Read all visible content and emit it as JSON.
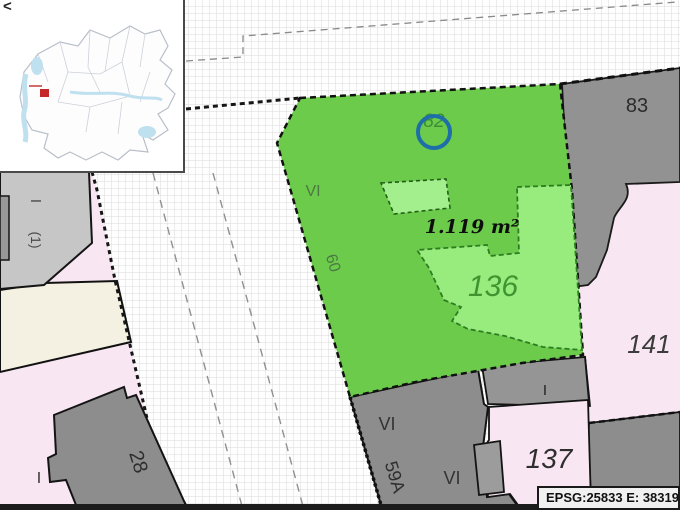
{
  "status_bar": {
    "text": "EPSG:25833 E: 38319"
  },
  "overview_map": {
    "collapse_icon": "<"
  },
  "labels": {
    "marker_82": "82",
    "floors_vi_green": "VI",
    "house_60": "60",
    "area_1119": "1.119 m²",
    "parcel_136": "136",
    "house_83": "83",
    "parcel_141": "141",
    "parcel_137": "137",
    "floors_i_finger": "I",
    "floors_vi_upper": "VI",
    "house_59a": "59A",
    "floors_vi_lower": "VI",
    "house_28": "28",
    "floors_i_west": "I",
    "floors_i_building": "I",
    "units_1": "(1)"
  },
  "colors": {
    "selected_parcel_green": "#6ccb4b",
    "subparcel_light_green": "#97ec7d",
    "inner_building_green": "#a4ef8d",
    "building_gray": "#8d8d8d",
    "building_light_gray": "#c6c6c6",
    "parcel_pink": "#f8e7f2",
    "parcel_cream": "#f4f1e3",
    "marker_blue": "#1e6fa8",
    "overview_marker_red": "#c62828"
  }
}
